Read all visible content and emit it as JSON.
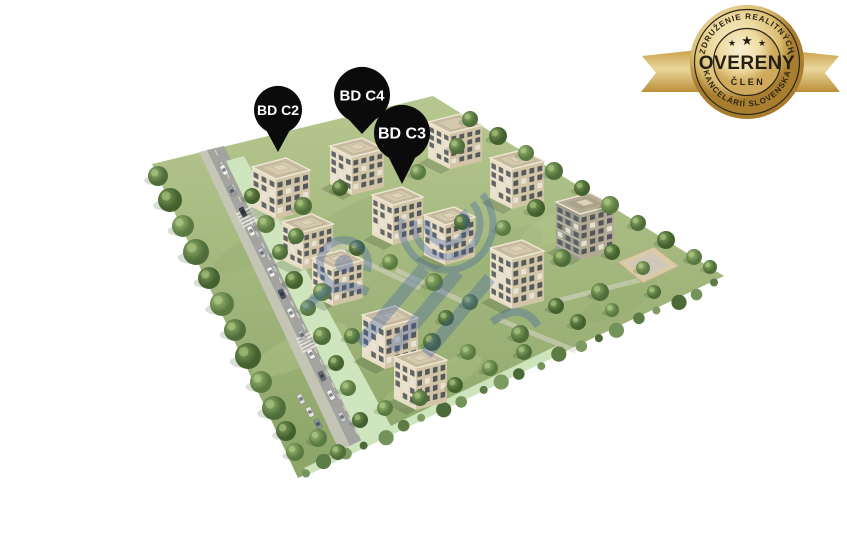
{
  "image": {
    "description": "Aerial 3D architectural visualization of a residential development with apartment blocks, greenery and an access road",
    "background": "#ffffff"
  },
  "pins": [
    {
      "label": "BD C2",
      "cx": 278,
      "cy": 110,
      "r": 24,
      "tip_y": 152,
      "font_size": 14
    },
    {
      "label": "BD C4",
      "cx": 362,
      "cy": 95,
      "r": 28,
      "tip_y": 134,
      "font_size": 15
    },
    {
      "label": "BD C3",
      "cx": 402,
      "cy": 133,
      "r": 28,
      "tip_y": 184,
      "font_size": 16
    }
  ],
  "badge": {
    "arc_top": "ZDRUŽENIE REALITNÝCH",
    "title": "OVERENÝ",
    "subtitle": "ČLEN",
    "arc_bottom": "KANCELÁRIÍ SLOVENSKA",
    "stars": [
      "★",
      "★",
      "★"
    ],
    "colors": {
      "gold_dark": "#a87e2e",
      "gold_mid": "#d9b564",
      "gold_light": "#f6ecc8",
      "text": "#241f15"
    }
  },
  "colors": {
    "pin": "#0b0b0b",
    "pin_text": "#ffffff",
    "watermark_blue": "#3f63a8",
    "grass": "#9eb67c",
    "road": "#a3a3a0",
    "mint_path": "#cfe5bd",
    "building_wall": "#e8dec6",
    "building_shade": "#d2c5a7",
    "tree_dark": "#4b6a38",
    "tree_light": "#8fae68"
  },
  "scene": {
    "plot": [
      [
        152,
        164
      ],
      [
        433,
        96
      ],
      [
        724,
        276
      ],
      [
        298,
        478
      ]
    ],
    "sidewalk": [
      [
        199,
        152
      ],
      [
        207,
        150
      ],
      [
        352,
        450
      ],
      [
        341,
        454
      ]
    ],
    "road": [
      [
        207,
        150
      ],
      [
        224,
        146
      ],
      [
        374,
        440
      ],
      [
        352,
        450
      ]
    ],
    "road_line": [
      [
        215,
        150
      ],
      [
        362,
        443
      ]
    ],
    "mint_band": [
      [
        226,
        161
      ],
      [
        244,
        156
      ],
      [
        392,
        428
      ],
      [
        362,
        442
      ]
    ],
    "mint_bottom": [
      [
        304,
        468
      ],
      [
        556,
        346
      ],
      [
        563,
        353
      ],
      [
        310,
        474
      ]
    ],
    "paths": [
      [
        [
          262,
          212
        ],
        [
          352,
          250
        ]
      ],
      [
        [
          396,
          270
        ],
        [
          470,
          305
        ]
      ],
      [
        [
          500,
          320
        ],
        [
          576,
          351
        ]
      ],
      [
        [
          330,
          246
        ],
        [
          420,
          288
        ]
      ],
      [
        [
          560,
          300
        ],
        [
          640,
          280
        ]
      ]
    ],
    "crosswalks": [
      [
        247,
        216
      ],
      [
        307,
        341
      ]
    ],
    "playground": {
      "outer": [
        [
          618,
          262
        ],
        [
          654,
          247
        ],
        [
          679,
          266
        ],
        [
          643,
          283
        ]
      ],
      "inner": [
        [
          628,
          263
        ],
        [
          653,
          253
        ],
        [
          669,
          266
        ],
        [
          644,
          277
        ]
      ]
    },
    "patches": [
      [
        360,
        220,
        60,
        18,
        "#7f9c5e",
        0.16
      ],
      [
        480,
        262,
        70,
        20,
        "#7f9c5e",
        0.13
      ],
      [
        300,
        350,
        52,
        16,
        "#cadc9f",
        0.22
      ],
      [
        620,
        300,
        42,
        14,
        "#7f9c5e",
        0.14
      ],
      [
        432,
        382,
        55,
        15,
        "#cadc9f",
        0.18
      ],
      [
        250,
        252,
        40,
        13,
        "#7f9c5e",
        0.14
      ],
      [
        560,
        225,
        45,
        14,
        "#cadc9f",
        0.16
      ]
    ],
    "buildings": [
      {
        "w": [
          428,
          122
        ],
        "a": [
          32,
          -8
        ],
        "b": [
          22,
          11
        ],
        "h": 36
      },
      {
        "w": [
          330,
          146
        ],
        "a": [
          32,
          -8
        ],
        "b": [
          22,
          11
        ],
        "h": 38
      },
      {
        "w": [
          490,
          158
        ],
        "a": [
          32,
          -8
        ],
        "b": [
          22,
          11
        ],
        "h": 40
      },
      {
        "w": [
          252,
          167
        ],
        "a": [
          34,
          -9
        ],
        "b": [
          24,
          12
        ],
        "h": 40
      },
      {
        "w": [
          372,
          195
        ],
        "a": [
          30,
          -8
        ],
        "b": [
          21,
          10
        ],
        "h": 40
      },
      {
        "w": [
          556,
          202
        ],
        "a": [
          34,
          -9
        ],
        "b": [
          24,
          12
        ],
        "h": 46,
        "dark": true
      },
      {
        "w": [
          424,
          215
        ],
        "a": [
          30,
          -8
        ],
        "b": [
          21,
          10
        ],
        "h": 40
      },
      {
        "w": [
          282,
          222
        ],
        "a": [
          30,
          -8
        ],
        "b": [
          21,
          10
        ],
        "h": 38
      },
      {
        "w": [
          490,
          248
        ],
        "a": [
          32,
          -8
        ],
        "b": [
          22,
          11
        ],
        "h": 50
      },
      {
        "w": [
          312,
          258
        ],
        "a": [
          30,
          -8
        ],
        "b": [
          21,
          10
        ],
        "h": 38
      },
      {
        "w": [
          362,
          315
        ],
        "a": [
          33,
          -9
        ],
        "b": [
          23,
          12
        ],
        "h": 42
      },
      {
        "w": [
          394,
          357
        ],
        "a": [
          31,
          -8
        ],
        "b": [
          22,
          11
        ],
        "h": 42
      }
    ],
    "trees": [
      [
        158,
        176,
        10
      ],
      [
        170,
        200,
        12
      ],
      [
        183,
        226,
        11
      ],
      [
        196,
        252,
        13
      ],
      [
        209,
        278,
        11
      ],
      [
        222,
        304,
        12
      ],
      [
        235,
        330,
        11
      ],
      [
        248,
        356,
        13
      ],
      [
        261,
        382,
        11
      ],
      [
        274,
        408,
        12
      ],
      [
        286,
        431,
        10
      ],
      [
        295,
        452,
        9
      ],
      [
        470,
        119,
        8
      ],
      [
        498,
        136,
        9
      ],
      [
        526,
        153,
        8
      ],
      [
        554,
        171,
        9
      ],
      [
        582,
        188,
        8
      ],
      [
        610,
        205,
        9
      ],
      [
        638,
        223,
        8
      ],
      [
        666,
        240,
        9
      ],
      [
        694,
        257,
        8
      ],
      [
        710,
        267,
        7
      ],
      [
        252,
        196,
        8
      ],
      [
        266,
        224,
        9
      ],
      [
        280,
        252,
        8
      ],
      [
        294,
        280,
        9
      ],
      [
        308,
        308,
        8
      ],
      [
        322,
        336,
        9
      ],
      [
        336,
        363,
        8
      ],
      [
        348,
        388,
        8
      ],
      [
        303,
        206,
        9
      ],
      [
        340,
        188,
        8
      ],
      [
        418,
        172,
        8
      ],
      [
        457,
        146,
        8
      ],
      [
        536,
        208,
        9
      ],
      [
        503,
        228,
        8
      ],
      [
        562,
        258,
        9
      ],
      [
        612,
        252,
        8
      ],
      [
        643,
        268,
        7
      ],
      [
        600,
        292,
        9
      ],
      [
        556,
        306,
        8
      ],
      [
        434,
        282,
        9
      ],
      [
        470,
        302,
        8
      ],
      [
        357,
        248,
        8
      ],
      [
        322,
        292,
        9
      ],
      [
        352,
        336,
        8
      ],
      [
        432,
        342,
        9
      ],
      [
        468,
        352,
        8
      ],
      [
        520,
        334,
        9
      ],
      [
        578,
        322,
        8
      ],
      [
        612,
        310,
        7
      ],
      [
        654,
        292,
        7
      ],
      [
        462,
        222,
        8
      ],
      [
        390,
        262,
        8
      ],
      [
        296,
        236,
        8
      ],
      [
        446,
        318,
        8
      ],
      [
        318,
        438,
        9
      ],
      [
        338,
        452,
        8
      ],
      [
        360,
        420,
        8
      ],
      [
        385,
        408,
        8
      ],
      [
        420,
        398,
        8
      ],
      [
        455,
        385,
        8
      ],
      [
        490,
        368,
        8
      ],
      [
        524,
        352,
        8
      ]
    ],
    "cars": [
      [
        224,
        170,
        "#f0f0ee"
      ],
      [
        232,
        191,
        "#9aa0a6"
      ],
      [
        243,
        212,
        "#41464d"
      ],
      [
        251,
        231,
        "#f0f0ee"
      ],
      [
        262,
        253,
        "#c6cace"
      ],
      [
        271,
        272,
        "#f0f0ee"
      ],
      [
        282,
        294,
        "#4d5565"
      ],
      [
        291,
        313,
        "#f0f0ee"
      ],
      [
        302,
        335,
        "#b5b9be"
      ],
      [
        311,
        354,
        "#f0f0ee"
      ],
      [
        322,
        376,
        "#666d79"
      ],
      [
        331,
        395,
        "#f0f0ee"
      ],
      [
        342,
        417,
        "#c6cace"
      ],
      [
        310,
        412,
        "#e8e8e6"
      ],
      [
        318,
        424,
        "#8b93a0"
      ],
      [
        301,
        399,
        "#d8dadd"
      ]
    ],
    "hedge": {
      "p1": [
        716,
        284
      ],
      "p2": [
        306,
        472
      ],
      "n": 22
    }
  }
}
